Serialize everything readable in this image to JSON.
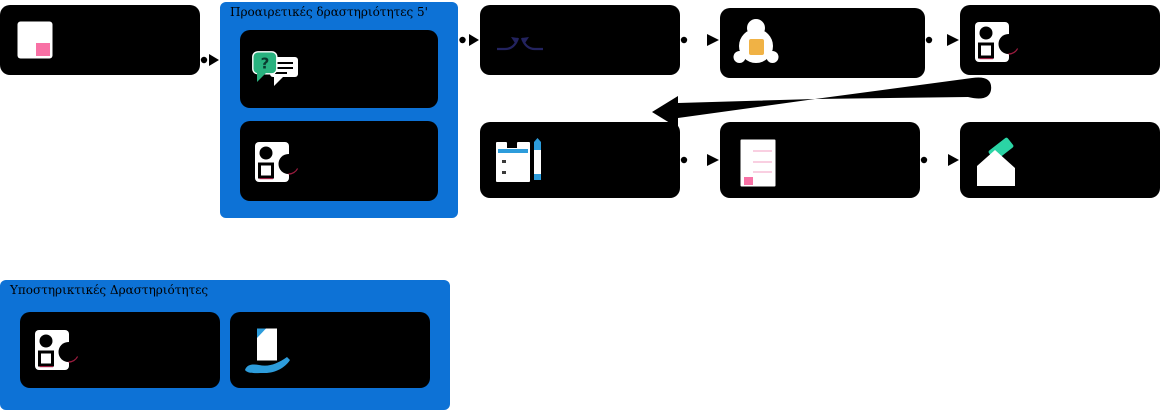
{
  "canvas": {
    "width": 1162,
    "height": 412
  },
  "groups": {
    "optional": {
      "title": "Προαιρετικές δραστηριότητες 5'"
    },
    "supportive": {
      "title": "Υποστηρικτικές Δραστηριότητες"
    }
  },
  "flow": {
    "row1": [
      {
        "icon": "picture-frame-icon"
      },
      {
        "group": "optional",
        "icon": "question-chat-icon"
      },
      {
        "group": "optional",
        "icon": "shapes-icon"
      },
      {
        "icon": "collision-arrows-icon"
      },
      {
        "icon": "bell-icon"
      },
      {
        "icon": "shapes-icon"
      }
    ],
    "row2": [
      {
        "icon": "notepad-pencil-icon"
      },
      {
        "icon": "document-icon"
      },
      {
        "icon": "ballot-envelope-icon"
      }
    ],
    "supportive_row": [
      {
        "icon": "shapes-icon"
      },
      {
        "icon": "hand-document-icon"
      }
    ]
  },
  "colors": {
    "group_background": "#0d72d6",
    "node_background": "#000000",
    "connector": "#000000",
    "pink": "#f871a5",
    "light_pink": "#f9cfe1",
    "green": "#29b27f",
    "yellow": "#f0b245",
    "sky_blue": "#2d9cdb",
    "teal": "#2bd4a5",
    "navy": "#23235f",
    "crimson": "#9c1c3f",
    "white": "#ffffff"
  }
}
